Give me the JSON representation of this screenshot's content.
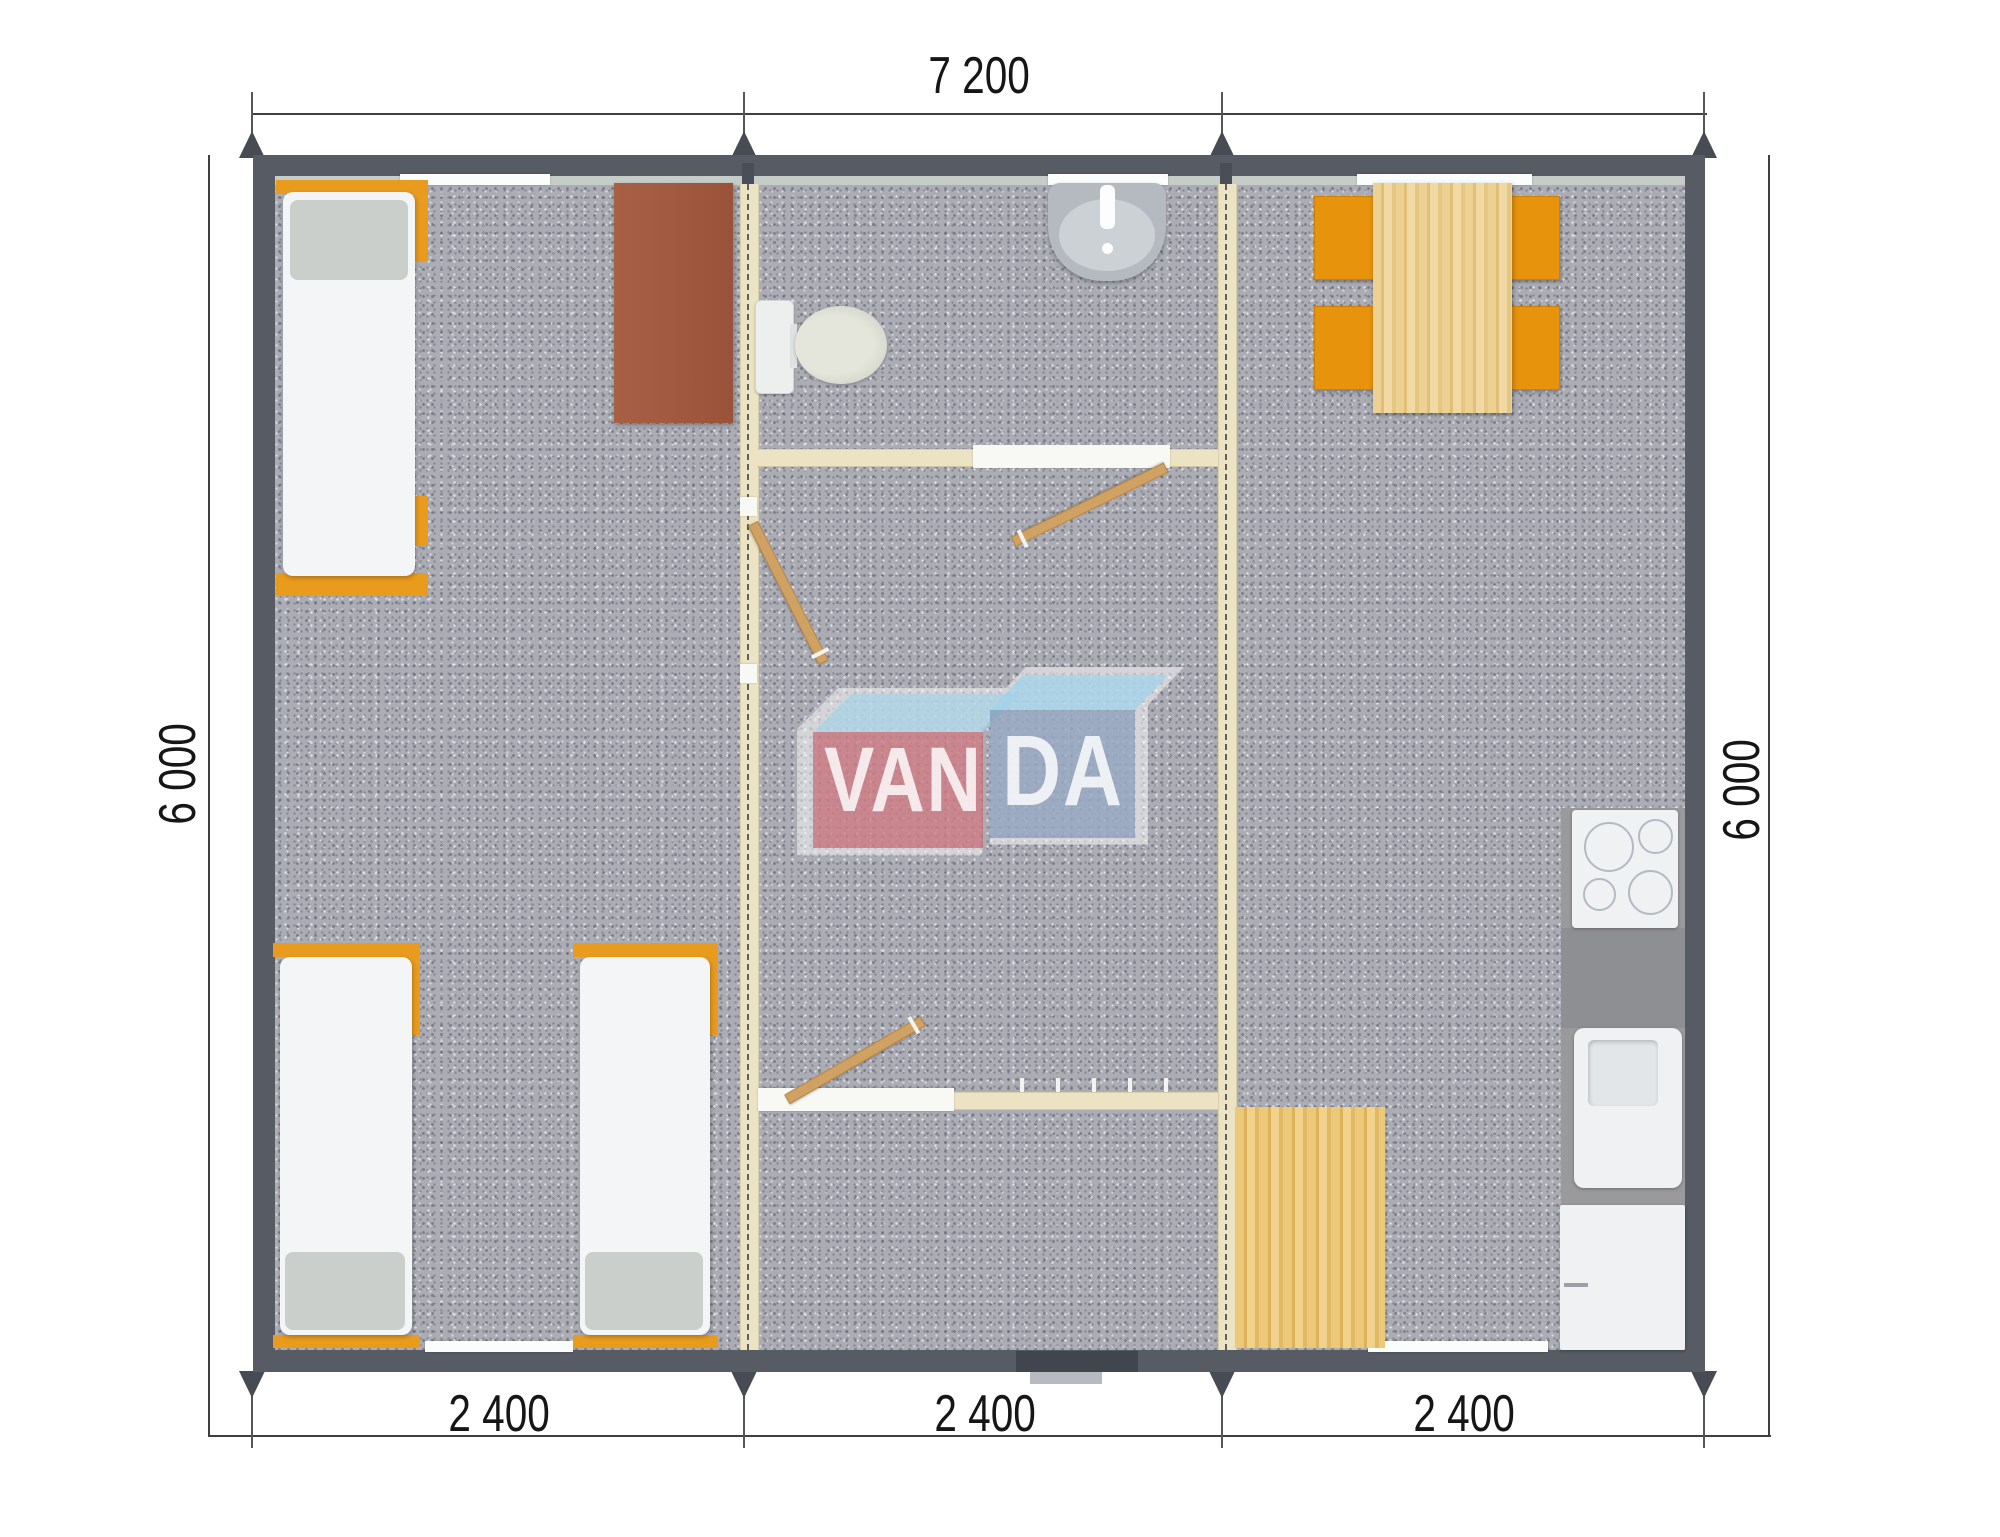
{
  "document": {
    "type": "floor-plan-render",
    "brand": "VANDA"
  },
  "dimension_labels": {
    "top": "7 200",
    "left": "6 000",
    "right": "6 000",
    "bottom": [
      "2 400",
      "2 400",
      "2 400"
    ]
  },
  "logo": {
    "left_text": "VAN",
    "right_text": "DA"
  },
  "colors": {
    "exterior_wall": "#565b64",
    "inner_rail": "#c6ccc8",
    "floor_carpet": "#abacb4",
    "module_joint_wall": "#ebe3c3",
    "bed_frame_orange": "#e89b1c",
    "chair_orange": "#e8930c",
    "table_wood": "#e9cd8c",
    "entry_mat_wood": "#e6c06b",
    "desk_brown": "#a05a40",
    "kitchen_counter": "#9a9a9c",
    "door_leaf_wood": "#cfa162",
    "dimension_text": "#161616",
    "logo_red": "#c2555f",
    "logo_blue": "#7e95b4",
    "logo_top_blue": "#a7d3e6"
  },
  "elements": [
    "bed",
    "bed",
    "bed",
    "desk",
    "toilet",
    "wash-basin",
    "interior-door",
    "interior-door",
    "interior-door",
    "coat-hooks",
    "dining-table",
    "chair",
    "chair",
    "chair",
    "chair",
    "cooktop",
    "kitchen-sink",
    "fridge",
    "entry-mat",
    "entry-threshold",
    "window",
    "window",
    "window",
    "window",
    "window",
    "vanda-logo-watermark"
  ]
}
